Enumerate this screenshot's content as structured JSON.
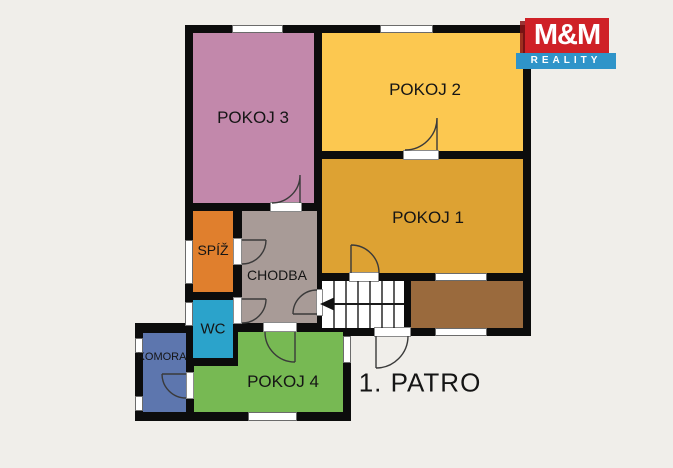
{
  "plan": {
    "floor_label": "1. PATRO",
    "background": "#f0eeea",
    "wall_color": "#0c0c0c",
    "rooms": [
      {
        "key": "pokoj3",
        "label": "POKOJ 3",
        "color": "#c288ab"
      },
      {
        "key": "pokoj2",
        "label": "POKOJ 2",
        "color": "#fcc850"
      },
      {
        "key": "pokoj1",
        "label": "POKOJ 1",
        "color": "#dda233"
      },
      {
        "key": "spiz",
        "label": "SPÍŽ",
        "color": "#e07f2d"
      },
      {
        "key": "chodba",
        "label": "CHODBA",
        "color": "#a89b97"
      },
      {
        "key": "wc",
        "label": "WC",
        "color": "#2ba3cb"
      },
      {
        "key": "pokoj4",
        "label": "POKOJ 4",
        "color": "#77b953"
      },
      {
        "key": "komora",
        "label": "KOMORA",
        "color": "#5d76ae"
      }
    ],
    "unlabeled_areas": [
      {
        "key": "balcony",
        "color": "#9a6a3d"
      },
      {
        "key": "stairs",
        "color": "#ffffff",
        "arrow_direction": "left"
      }
    ]
  },
  "logo": {
    "title": "M&M",
    "subtitle": "REALITY",
    "red": "#cf2127",
    "blue": "#2f94c9",
    "text_color": "#ffffff"
  }
}
